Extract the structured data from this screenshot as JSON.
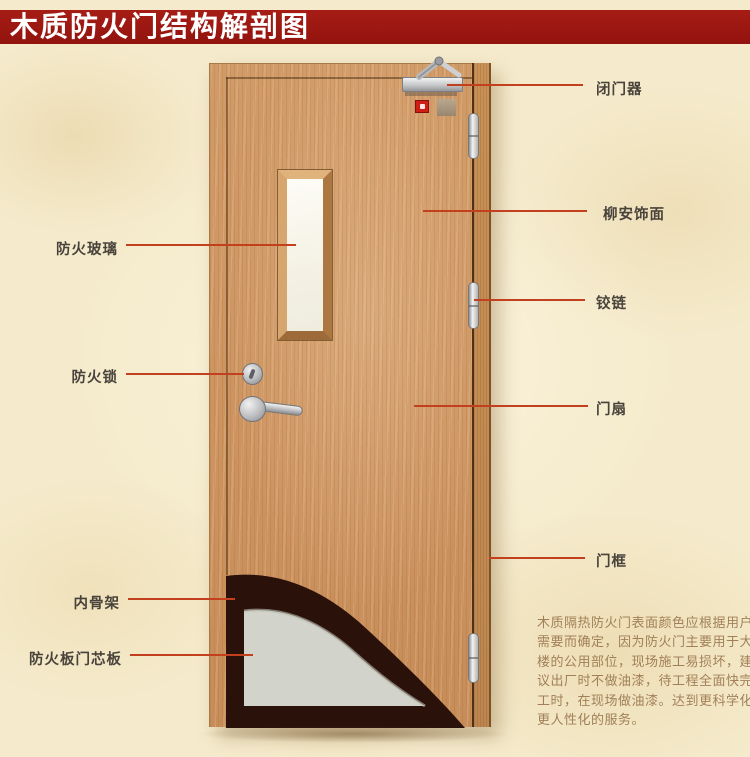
{
  "title": "木质防火门结构解剖图",
  "labels": {
    "left": [
      {
        "text": "防火玻璃"
      },
      {
        "text": "防火锁"
      },
      {
        "text": "内骨架"
      },
      {
        "text": "防火板门芯板"
      }
    ],
    "right": [
      {
        "text": "闭门器"
      },
      {
        "text": "柳安饰面"
      },
      {
        "text": "铰链"
      },
      {
        "text": "门扇"
      },
      {
        "text": "门框"
      }
    ]
  },
  "description": {
    "lines": [
      "木质隔热防火门表面颜色应根据用户",
      "需要而确定，因为防火门主要用于大",
      "楼的公用部位，现场施工易损坏，建",
      "议出厂时不做油漆，待工程全面快完",
      "工时，在现场做油漆。达到更科学化",
      "更人性化的服务。"
    ]
  },
  "colors": {
    "banner_red": "#9a1712",
    "leader_line_red": "#c2401e",
    "label_text": "#49433b",
    "description_text": "#a18059",
    "background_cream": "#f5ebcc",
    "door_wood": "#cd9460",
    "frame_wood": "#bd8650",
    "glass_white": "#f9f7ee",
    "core_panel_gray": "#d2d3ca",
    "inner_frame_dark": "#2a110a"
  }
}
